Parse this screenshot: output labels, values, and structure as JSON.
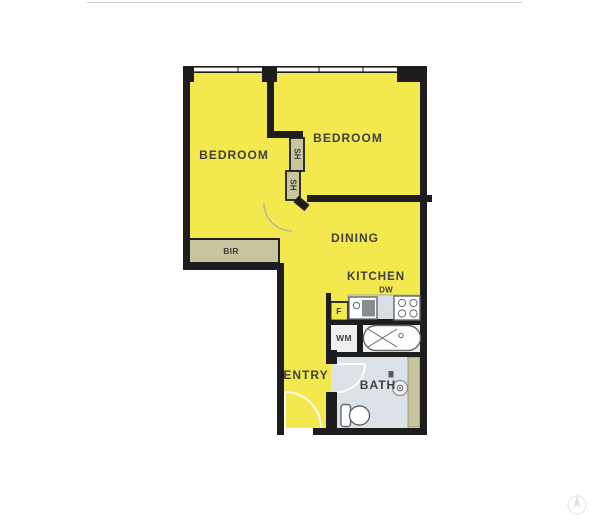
{
  "plan": {
    "description": "Two bedroom apartment floor plan",
    "labels": {
      "bedroom1": "BEDROOM",
      "bedroom2": "BEDROOM",
      "dining": "DINING",
      "kitchen": "KITCHEN",
      "entry": "ENTRY",
      "bath": "BATH",
      "bir": "BIR",
      "shelf1": "SH",
      "shelf2": "SH",
      "dishwasher": "DW",
      "fridge": "F",
      "washing_machine": "WM"
    }
  },
  "colors": {
    "yellow": "#f3e84e",
    "khaki": "#c8c49e",
    "bath": "#dde2e9",
    "counter": "#d9dee4",
    "nook": "#eef0f2",
    "wall": "#1d1d1d",
    "label": "#3f3f3f",
    "fixture": "#63686e",
    "topline": "#cdcdcd",
    "arc": "#ffffff",
    "bedarc": "#bdb99f"
  }
}
